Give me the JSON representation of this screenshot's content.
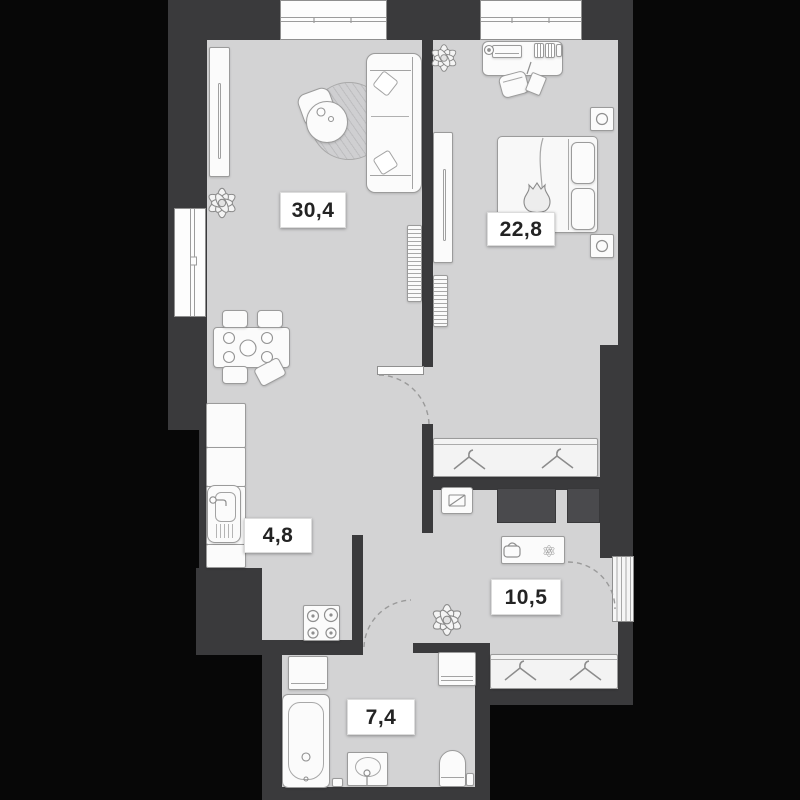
{
  "plan": {
    "rooms": {
      "living": {
        "label": "30,4"
      },
      "bedroom": {
        "label": "22,8"
      },
      "kitchen": {
        "label": "4,8"
      },
      "hallway": {
        "label": "10,5"
      },
      "bathroom": {
        "label": "7,4"
      }
    },
    "colors": {
      "background": "#070707",
      "wall": "#3a3a3c",
      "floor": "#d3d3d4",
      "furniture_fill": "#fbfbfb",
      "furniture_outline": "#9b9b9b",
      "dark_cabinet": "#4a4a4d",
      "label_background": "#ffffff",
      "label_text": "#232323"
    },
    "icons": {
      "plant": "plant-icon",
      "hanger": "hanger-icon"
    }
  }
}
